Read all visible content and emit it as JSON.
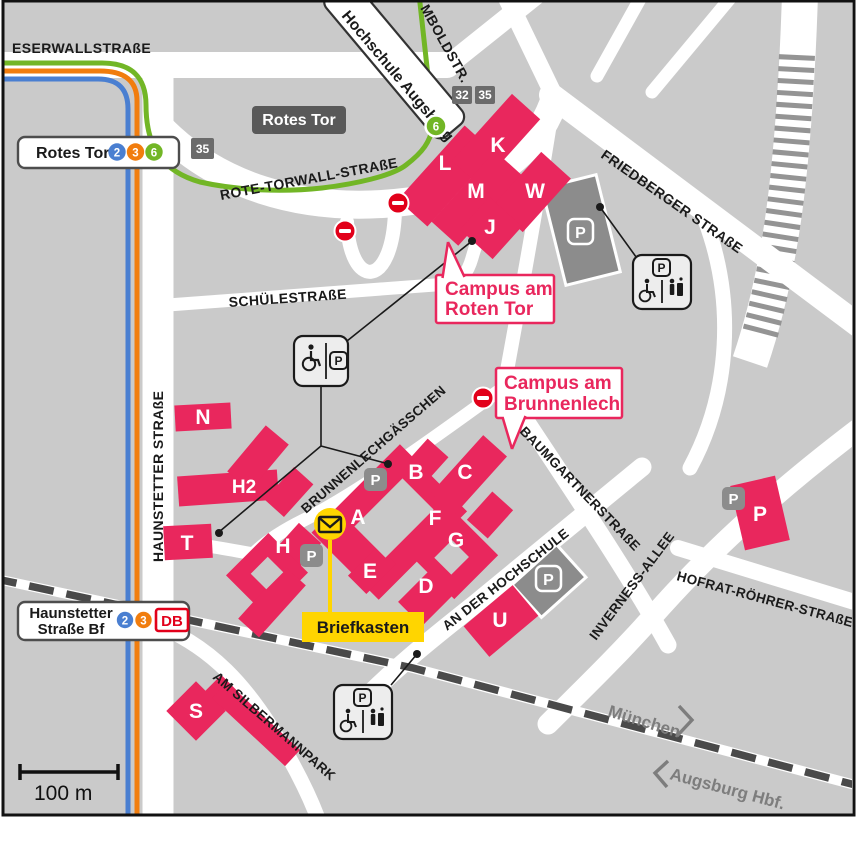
{
  "colors": {
    "background": "#cacaca",
    "road": "#ffffff",
    "building": "#e9275d",
    "accent_pink": "#e9275d",
    "parking_gray": "#8c8c8c",
    "dark_sign": "#595959",
    "badge_gray": "#6b6b6b",
    "tram_2_blue": "#4a7fd1",
    "tram_3_orange": "#f17d0e",
    "tram_6_green": "#72b626",
    "db_red": "#e2001a",
    "prohibition_red": "#e2001a",
    "postbox_yellow": "#ffd500",
    "rail_dark": "#4a4a4a",
    "direction_gray": "#7d7d7d"
  },
  "streets": {
    "eserwallstrasse": "ESERWALLSTRAßE",
    "rote_torwall_strasse": "ROTE-TORWALL-STRAßE",
    "schuelestrasse": "SCHÜLESTRAßE",
    "haunstetter_strasse": "HAUNSTETTER STRAßE",
    "friedberger_strasse": "FRIEDBERGER STRAßE",
    "humboldtstr": "MBOLDSTR.",
    "brunnenlechgaesschen": "BRUNNENLECHGÄSSCHEN",
    "baumgartnerstrasse": "BAUMGARTNERSTRAßE",
    "an_der_hochschule": "AN DER HOCHSCHULE",
    "inverness_allee": "INVERNESS-ALLEE",
    "hofrat_roehrer_strasse": "HOFRAT-RÖHRER-STRAßE",
    "am_silbermannpark": "AM SILBERMANNPARK"
  },
  "transit": {
    "rotes_tor_stop": {
      "name": "Rotes Tor",
      "line_2": "2",
      "line_3": "3",
      "line_6": "6"
    },
    "hochschule_stop": {
      "name": "Hochschule Augsburg",
      "line_6": "6"
    },
    "haunstetter_bf_stop": {
      "name_line1": "Haunstetter",
      "name_line2": "Straße Bf",
      "line_2": "2",
      "line_3": "3",
      "db_logo": "DB"
    },
    "rotes_tor_sign": "Rotes Tor",
    "bus_stop_32": "32",
    "bus_stop_35_a": "35",
    "bus_stop_35_b": "35",
    "direction_munich": "München",
    "direction_hbf": "Augsburg Hbf."
  },
  "campus": {
    "callout_roten_tor_line1": "Campus am",
    "callout_roten_tor_line2": "Roten Tor",
    "callout_brunnenlech_line1": "Campus am",
    "callout_brunnenlech_line2": "Brunnenlech",
    "buildings": [
      {
        "label": "L"
      },
      {
        "label": "K"
      },
      {
        "label": "M"
      },
      {
        "label": "W"
      },
      {
        "label": "J"
      },
      {
        "label": "N"
      },
      {
        "label": "H2"
      },
      {
        "label": "T"
      },
      {
        "label": "H"
      },
      {
        "label": "A"
      },
      {
        "label": "B"
      },
      {
        "label": "C"
      },
      {
        "label": "F"
      },
      {
        "label": "G"
      },
      {
        "label": "E"
      },
      {
        "label": "D"
      },
      {
        "label": "U"
      },
      {
        "label": "S"
      },
      {
        "label": "P"
      }
    ]
  },
  "parking": {
    "symbol": "P"
  },
  "postbox": {
    "label": "Briefkasten"
  },
  "scale": {
    "label": "100 m"
  }
}
